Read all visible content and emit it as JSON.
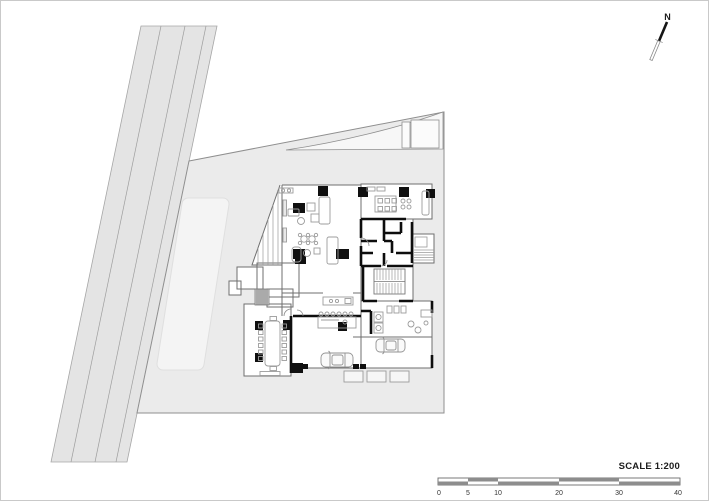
{
  "canvas": {
    "width": 709,
    "height": 501,
    "background": "#ffffff",
    "border_color": "#c9c9c9"
  },
  "north_arrow": {
    "label": "N"
  },
  "scale_bar": {
    "label": "SCALE 1:200",
    "ticks": [
      "0",
      "5",
      "10",
      "20",
      "30",
      "40"
    ],
    "dark_fill": "#8d8d8d",
    "outline_color": "#6a6a6a"
  },
  "plan": {
    "kind": "architectural-ground-floor-site-plan",
    "colors": {
      "site_fill": "#ebebeb",
      "road_fill": "#e4e4e4",
      "lawn_fill": "#f4f4f4",
      "floor_fill": "#ffffff",
      "heavy_wall": "#0d0d0d",
      "light_wall": "#6f6f6f",
      "furniture_line": "#9c9c9c",
      "column_fill": "#101010"
    },
    "features": [
      "road",
      "site-boundary",
      "lawn",
      "entry-wedge",
      "main-hall",
      "dining-room",
      "service-core",
      "staircase",
      "balcony",
      "bar-counter",
      "kitchen-island",
      "conference-room",
      "mudroom",
      "garage-court",
      "parking-stalls",
      "cars",
      "entrance-steps",
      "ramp"
    ]
  }
}
